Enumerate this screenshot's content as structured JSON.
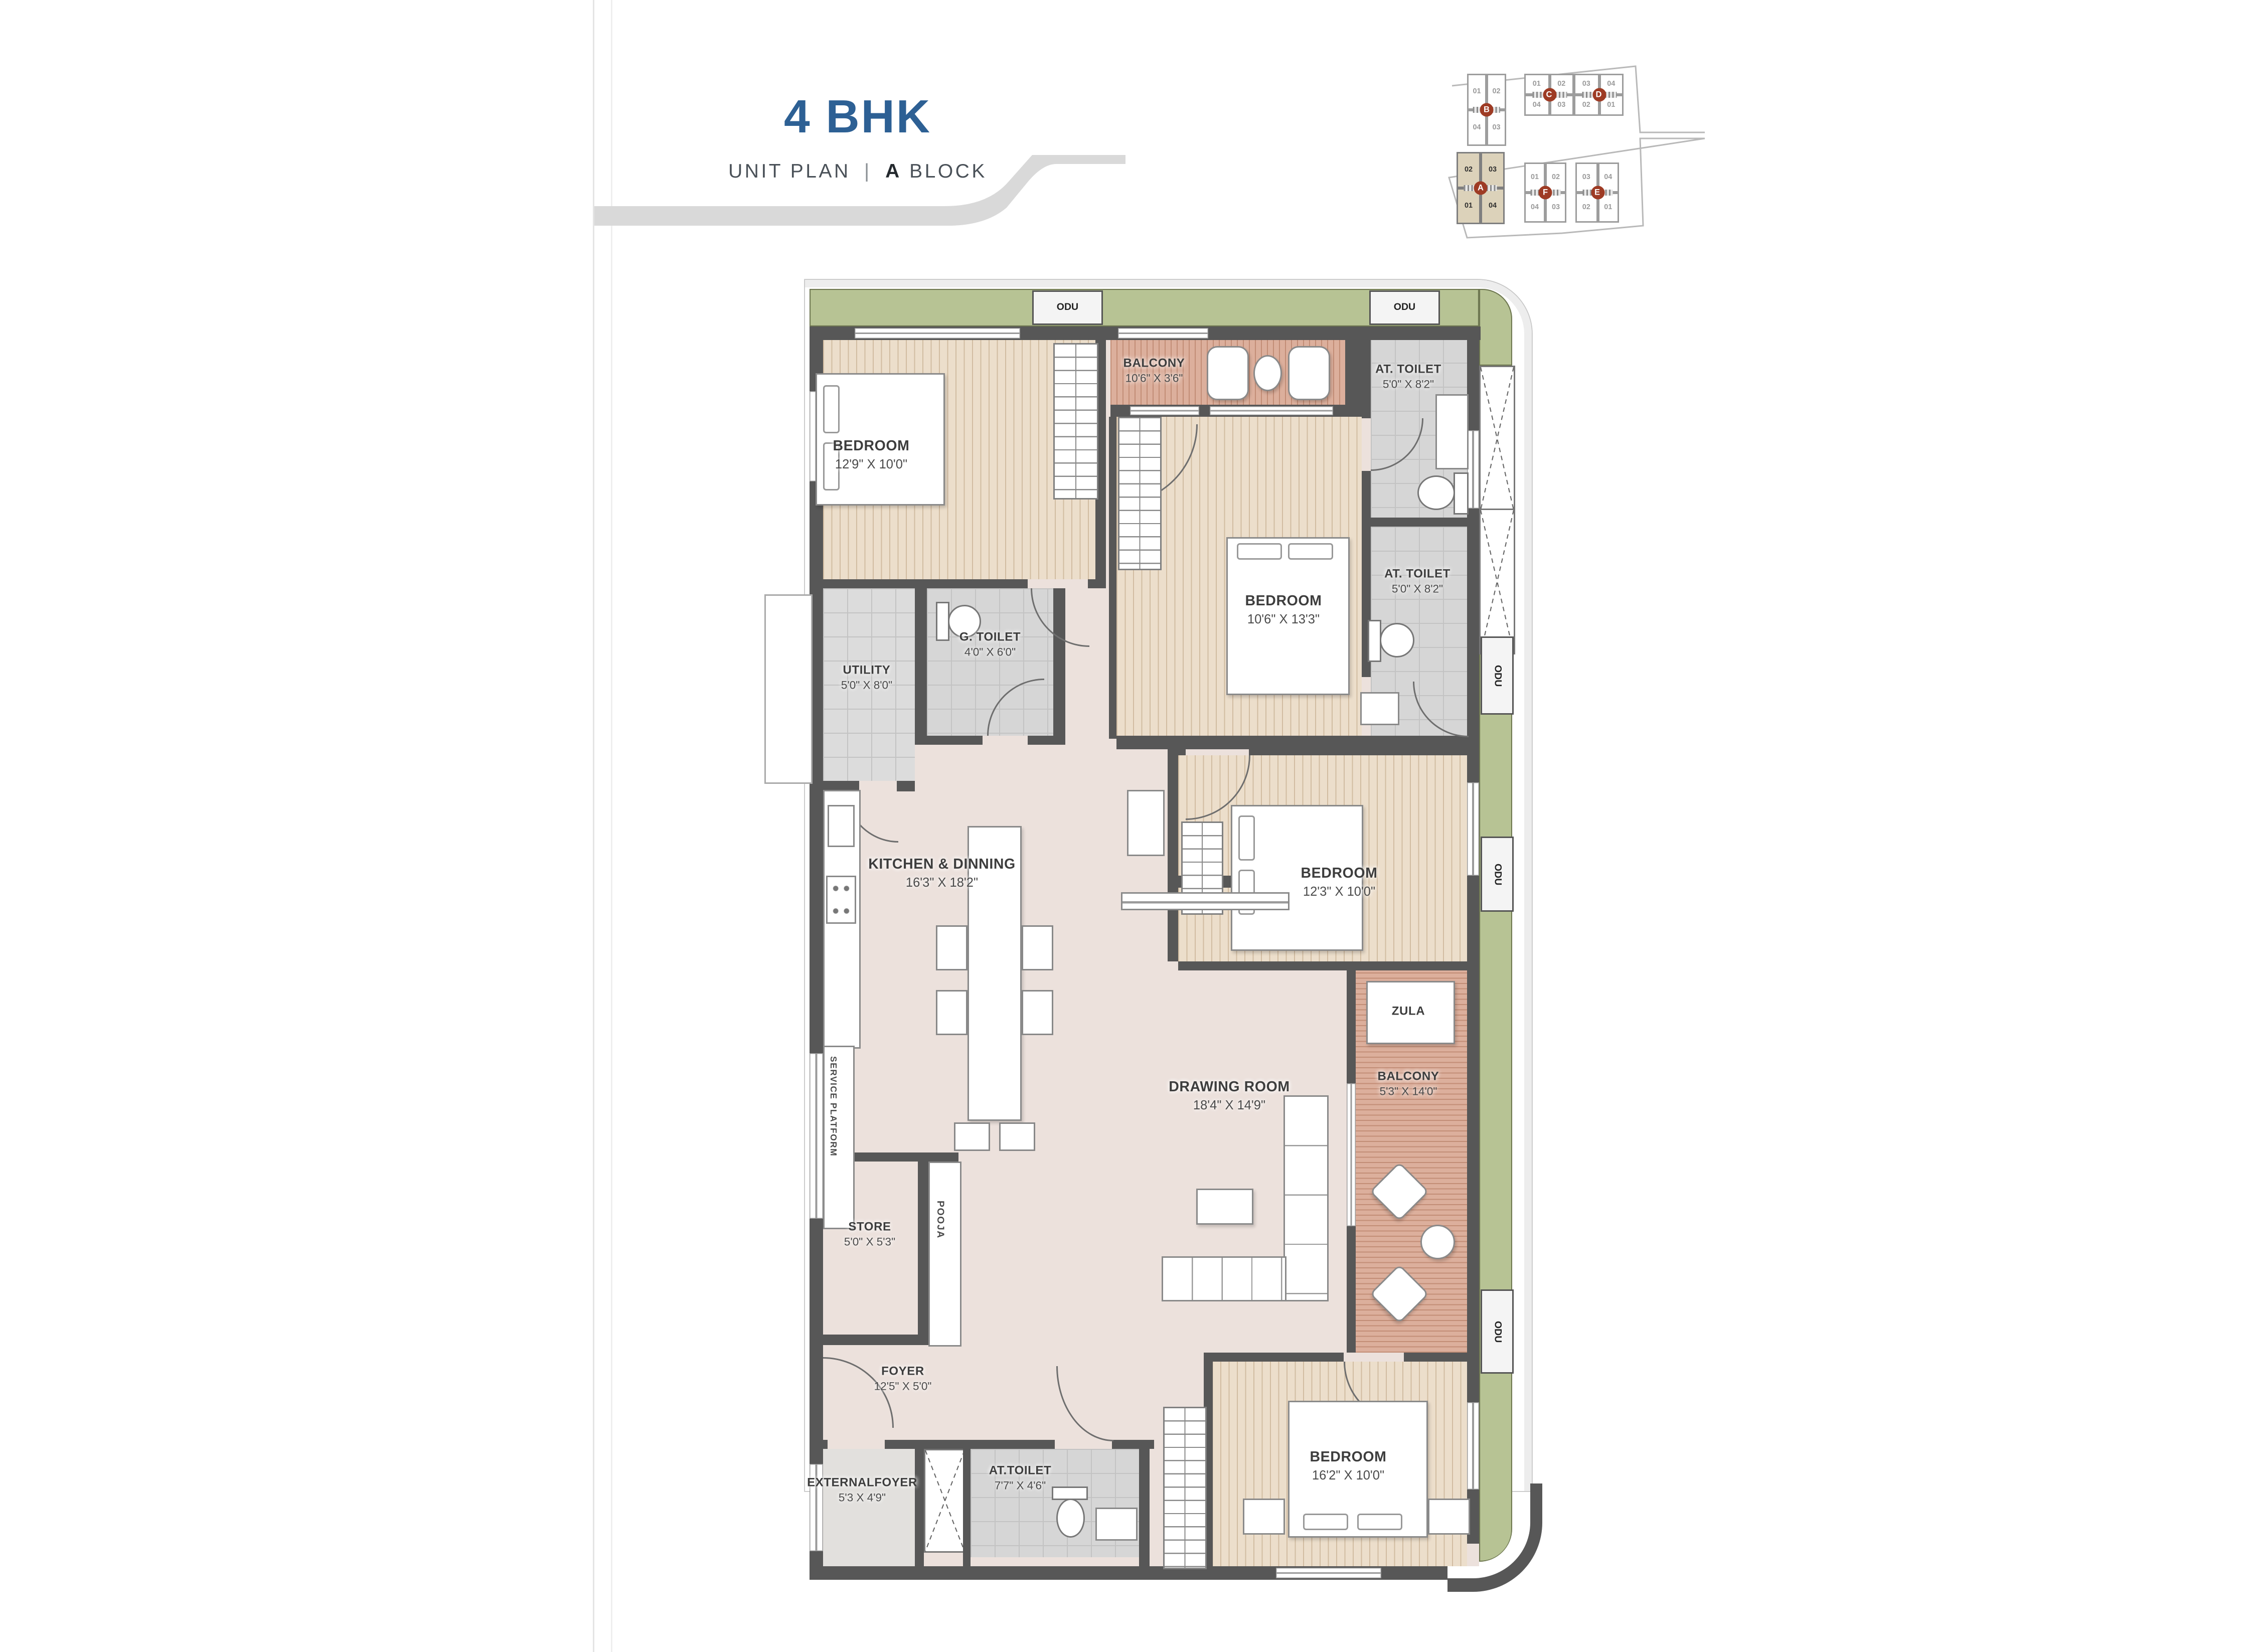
{
  "title": {
    "main": "4 BHK",
    "unit_plan": "UNIT PLAN",
    "divider": "|",
    "block_letter": "A",
    "block_word": "BLOCK"
  },
  "key_plan": {
    "blocks": [
      {
        "letter": "B",
        "top": [
          "01",
          "02"
        ],
        "bottom": [
          "04",
          "03"
        ],
        "highlighted": false
      },
      {
        "letter": "C",
        "top": [
          "01",
          "02"
        ],
        "bottom": [
          "04",
          "03"
        ],
        "highlighted": false
      },
      {
        "letter": "D",
        "top": [
          "03",
          "04"
        ],
        "bottom": [
          "02",
          "01"
        ],
        "highlighted": false
      },
      {
        "letter": "A",
        "top": [
          "02",
          "03"
        ],
        "bottom": [
          "01",
          "04"
        ],
        "highlighted": true
      },
      {
        "letter": "F",
        "top": [
          "01",
          "02"
        ],
        "bottom": [
          "04",
          "03"
        ],
        "highlighted": false
      },
      {
        "letter": "E",
        "top": [
          "03",
          "04"
        ],
        "bottom": [
          "02",
          "01"
        ],
        "highlighted": false
      }
    ]
  },
  "rooms": [
    {
      "id": "bedroom-1",
      "name": "BEDROOM",
      "dim": "12'9\" X 10'0\""
    },
    {
      "id": "balcony-top",
      "name": "BALCONY",
      "dim": "10'6\" X 3'6\""
    },
    {
      "id": "at-toilet-1",
      "name": "AT. TOILET",
      "dim": "5'0\" X 8'2\""
    },
    {
      "id": "bedroom-2",
      "name": "BEDROOM",
      "dim": "10'6\" X 13'3\""
    },
    {
      "id": "at-toilet-2",
      "name": "AT. TOILET",
      "dim": "5'0\" X 8'2\""
    },
    {
      "id": "g-toilet",
      "name": "G. TOILET",
      "dim": "4'0\" X 6'0\""
    },
    {
      "id": "utility",
      "name": "UTILITY",
      "dim": "5'0\" X 8'0\""
    },
    {
      "id": "kitchen-dining",
      "name": "KITCHEN & DINNING",
      "dim": "16'3\" X 18'2\""
    },
    {
      "id": "bedroom-3",
      "name": "BEDROOM",
      "dim": "12'3\" X 10'0\""
    },
    {
      "id": "drawing-room",
      "name": "DRAWING ROOM",
      "dim": "18'4\" X 14'9\""
    },
    {
      "id": "balcony-right",
      "name": "BALCONY",
      "dim": "5'3\" X 14'0\""
    },
    {
      "id": "store",
      "name": "STORE",
      "dim": "5'0\" X 5'3\""
    },
    {
      "id": "foyer",
      "name": "FOYER",
      "dim": "12'5\" X 5'0\""
    },
    {
      "id": "external-foyer",
      "name": "EXTERNALFOYER",
      "dim": "5'3 X 4'9\""
    },
    {
      "id": "at-toilet-3",
      "name": "AT.TOILET",
      "dim": "7'7\" X 4'6\""
    },
    {
      "id": "bedroom-4",
      "name": "BEDROOM",
      "dim": "16'2\" X 10'0\""
    }
  ],
  "labels": {
    "odu": "ODU",
    "zula": "ZULA",
    "pooja": "POOJA",
    "service_platform": "SERVICE PLATFORM"
  },
  "colors": {
    "accent_blue": "#2d6094",
    "wall_gray": "#575757",
    "landscape_green": "#b7c394",
    "floor_pink": "#ece1dc",
    "floor_tan": "#ecdecb",
    "floor_terracotta": "#dcaf9c",
    "tile_gray": "#d6d6d6",
    "keyplan_highlight": "#dcd2ba",
    "badge_red": "#9e3b24"
  }
}
